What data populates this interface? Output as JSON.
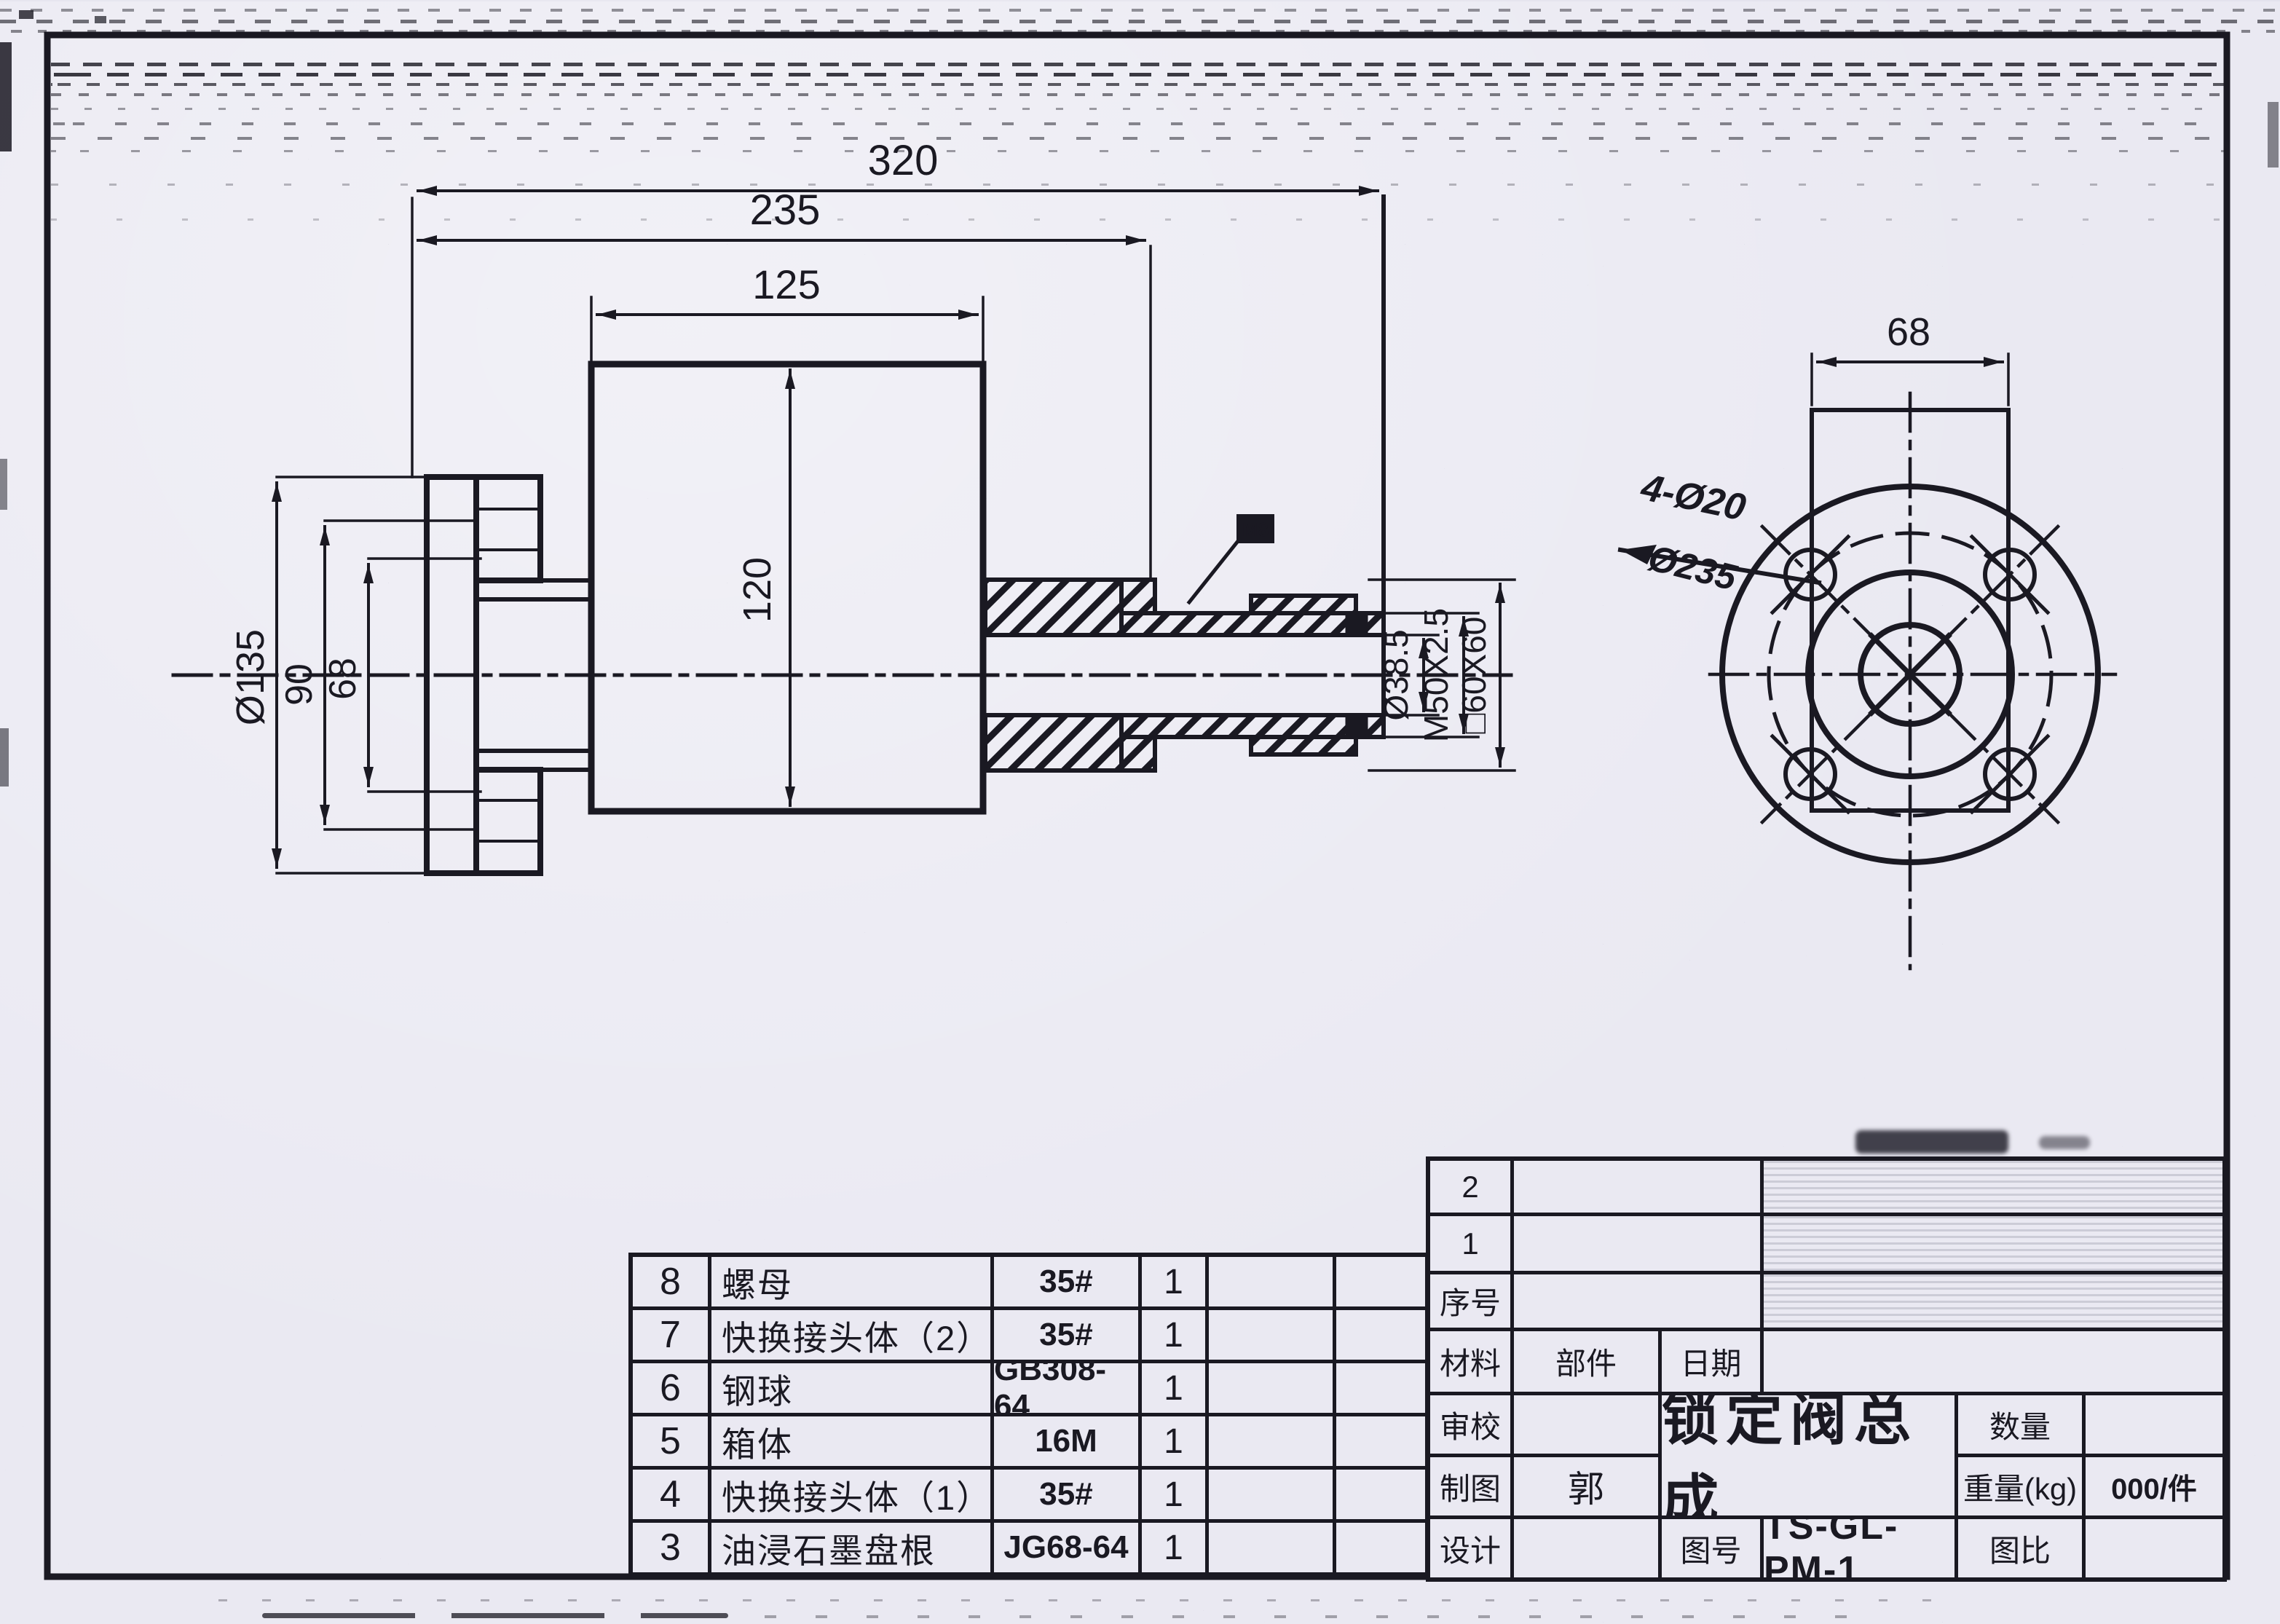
{
  "colors": {
    "paper": "#eae9f2",
    "ink": "#1a1922"
  },
  "side_view": {
    "dim_overall": "320",
    "dim_to_step": "235",
    "dim_body_width": "125",
    "dim_body_height": "120",
    "dim_flange_od": "Ø135",
    "dim_flange_step": "90",
    "dim_flange_bore": "68",
    "dim_shaft_bore": "Ø38.5",
    "dim_thread": "M50X2.5",
    "dim_square": "□60X60",
    "label_screw": "M8"
  },
  "end_view": {
    "dim_square_width": "68",
    "note_holes": "4-Ø20",
    "note_leader": "Ø235"
  },
  "parts_table": {
    "rows": [
      {
        "no": "8",
        "name": "螺母",
        "spec": "35#",
        "qty": "1"
      },
      {
        "no": "7",
        "name": "快换接头体（2）",
        "spec": "35#",
        "qty": "1"
      },
      {
        "no": "6",
        "name": "钢球",
        "spec": "GB308-64",
        "qty": "1"
      },
      {
        "no": "5",
        "name": "箱体",
        "spec": "16M",
        "qty": "1"
      },
      {
        "no": "4",
        "name": "快换接头体（1）",
        "spec": "35#",
        "qty": "1"
      },
      {
        "no": "3",
        "name": "油浸石墨盘根",
        "spec": "JG68-64",
        "qty": "1"
      }
    ]
  },
  "title_block": {
    "row_2": "2",
    "row_1": "1",
    "seq_label": "序号",
    "material_label": "材料",
    "part_label": "部件",
    "date_label": "日期",
    "check_label": "审校",
    "draft_label": "制图",
    "draft_value": "郭",
    "design_label": "设计",
    "drawing_title": "锁定阀总成",
    "qty_label": "数量",
    "weight_label": "重量(kg)",
    "weight_value": "000/件",
    "dwg_no_label": "图号",
    "dwg_no_value": "TS-GL-PM-1",
    "scale_label": "图比"
  }
}
